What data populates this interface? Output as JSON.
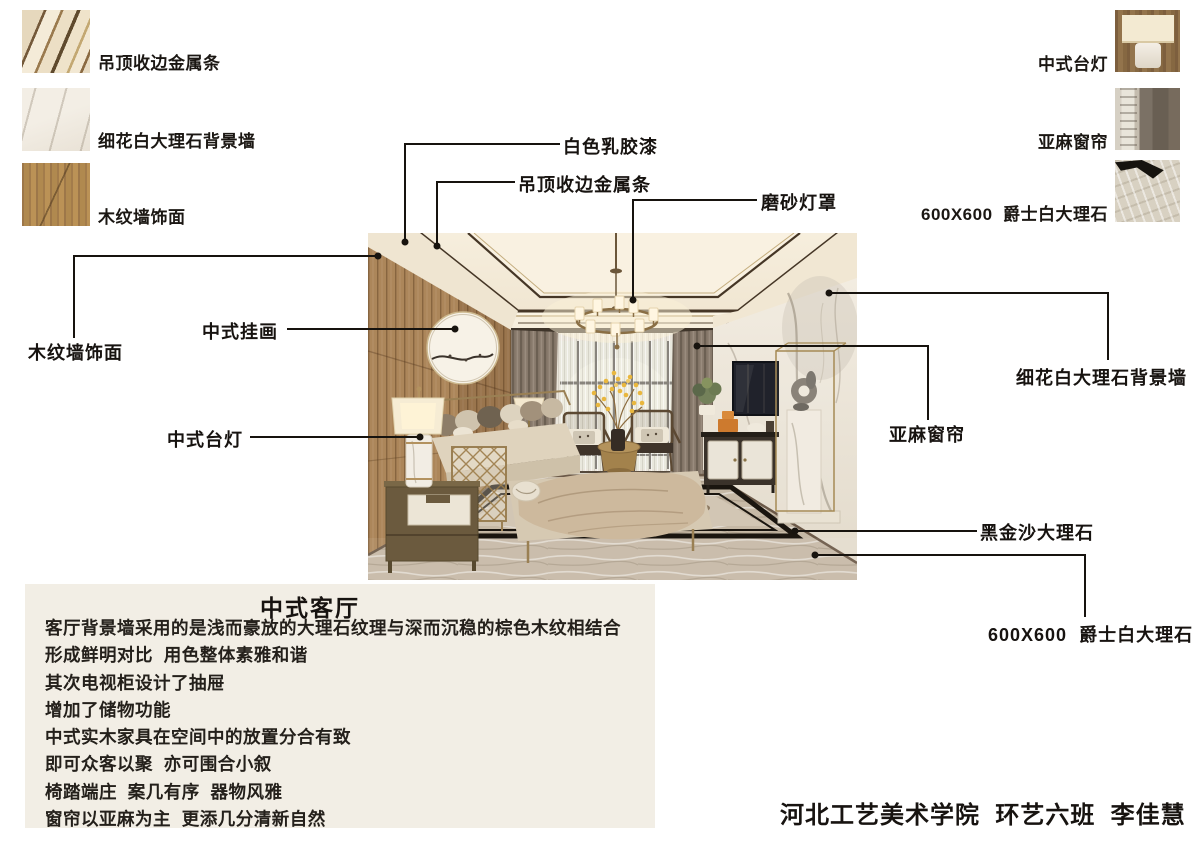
{
  "materials_left": [
    {
      "label": "吊顶收边金属条"
    },
    {
      "label": "细花白大理石背景墙"
    },
    {
      "label": "木纹墙饰面"
    }
  ],
  "materials_right": [
    {
      "label": "中式台灯"
    },
    {
      "label": "亚麻窗帘"
    },
    {
      "label": "600X600  爵士白大理石"
    }
  ],
  "callouts": {
    "white_paint": "白色乳胶漆",
    "ceiling_metal": "吊顶收边金属条",
    "frosted_shade": "磨砂灯罩",
    "wood_wall": "木纹墙饰面",
    "painting": "中式挂画",
    "lamp": "中式台灯",
    "marble_wall": "细花白大理石背景墙",
    "curtain": "亚麻窗帘",
    "black_marble": "黑金沙大理石",
    "floor_tile": "600X600  爵士白大理石"
  },
  "description": {
    "title": "中式客厅",
    "lines": [
      "客厅背景墙采用的是浅而豪放的大理石纹理与深而沉稳的棕色木纹相结合",
      "形成鲜明对比  用色整体素雅和谐",
      "其次电视柜设计了抽屉",
      "增加了储物功能",
      "中式实木家具在空间中的放置分合有致",
      "即可众客以聚  亦可围合小叙",
      "椅踏端庄  案几有序  器物风雅",
      "窗帘以亚麻为主  更添几分清新自然"
    ]
  },
  "signature": "河北工艺美术学院  环艺六班  李佳慧",
  "colors": {
    "line": "#17130e",
    "box_bg": "#f2eee5",
    "wood": "#ac865a",
    "ceiling": "#f4ecdb",
    "marble": "#efe9dd",
    "floor": "#c6b9a6",
    "accent_gold": "#9a8054"
  }
}
